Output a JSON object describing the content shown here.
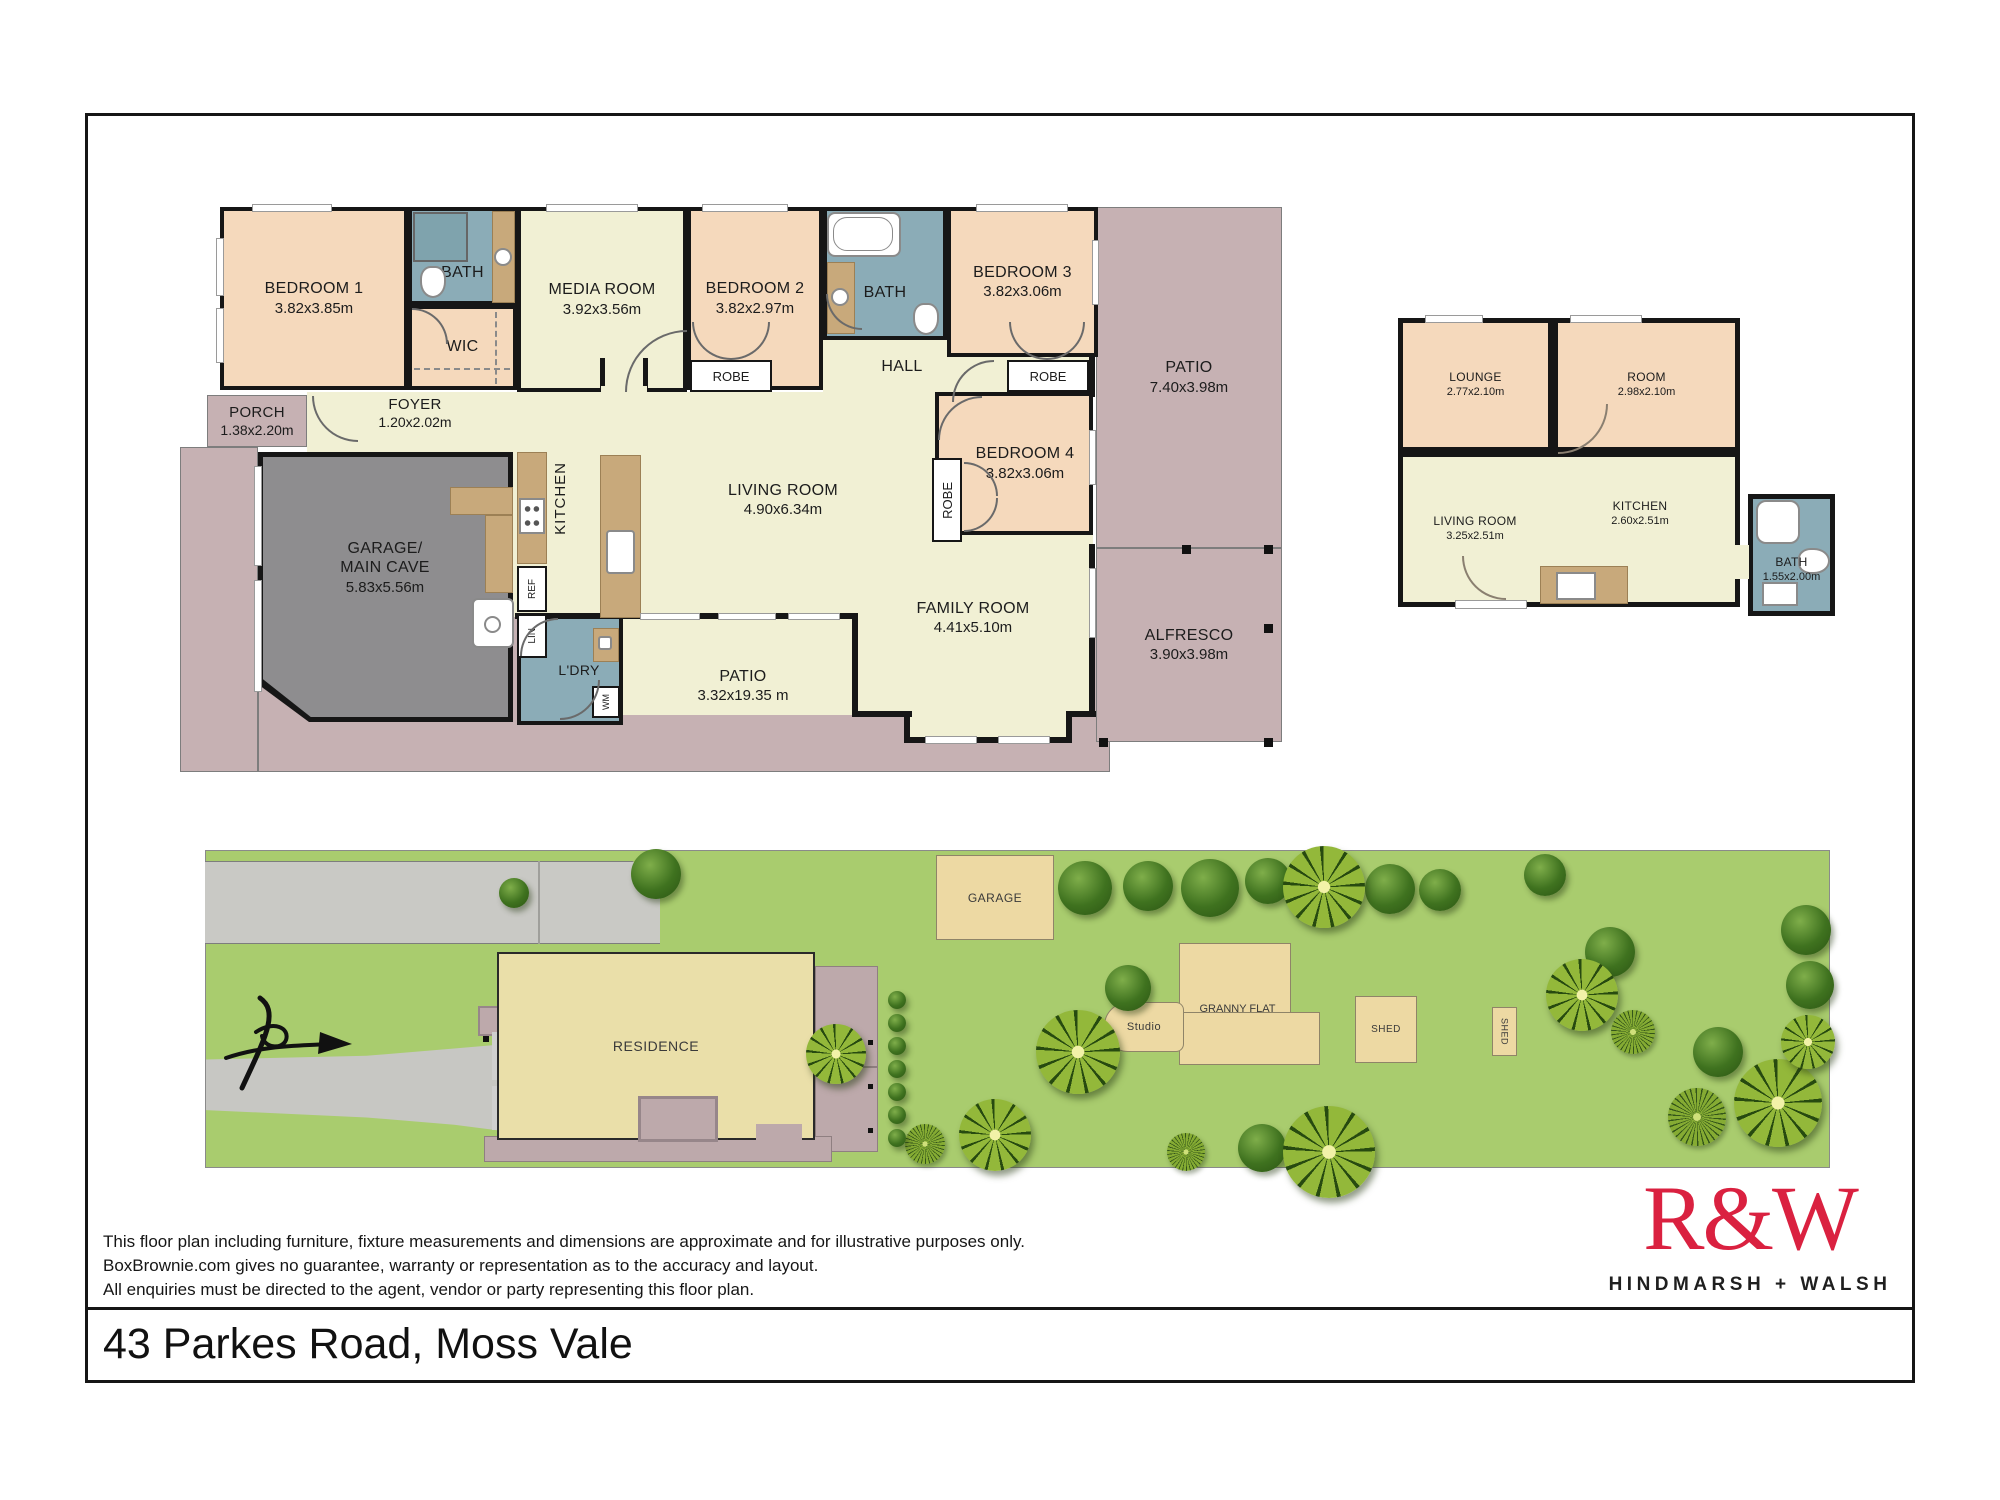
{
  "colors": {
    "brand_red": "#da2140",
    "peach_room": "#f5d9bc",
    "cream_room": "#f1f0d4",
    "teal_bath": "#8bacb7",
    "mauve_outdoor": "#c6b1b3",
    "garage_gray": "#8e8d8f",
    "site_grass": "#a9cc6e",
    "site_road": "#c9c9c5",
    "site_building": "#edd9a3",
    "site_residence": "#eadfa9"
  },
  "main_plan": {
    "bedroom1": {
      "name": "BEDROOM 1",
      "dims": "3.82x3.85m"
    },
    "bath1": {
      "name": "BATH"
    },
    "wic": {
      "name": "WIC"
    },
    "media": {
      "name": "MEDIA ROOM",
      "dims": "3.92x3.56m"
    },
    "bedroom2": {
      "name": "BEDROOM 2",
      "dims": "3.82x2.97m"
    },
    "bath2": {
      "name": "BATH"
    },
    "bedroom3": {
      "name": "BEDROOM 3",
      "dims": "3.82x3.06m"
    },
    "bedroom4": {
      "name": "BEDROOM 4",
      "dims": "3.82x3.06m"
    },
    "hall": {
      "name": "HALL"
    },
    "porch": {
      "name": "PORCH",
      "dims": "1.38x2.20m"
    },
    "foyer": {
      "name": "FOYER",
      "dims": "1.20x2.02m"
    },
    "garage": {
      "name_line1": "GARAGE/",
      "name_line2": "MAIN CAVE",
      "dims": "5.83x5.56m"
    },
    "kitchen": {
      "name": "KITCHEN"
    },
    "living": {
      "name": "LIVING ROOM",
      "dims": "4.90x6.34m"
    },
    "family": {
      "name": "FAMILY ROOM",
      "dims": "4.41x5.10m"
    },
    "laundry": {
      "name": "L'DRY"
    },
    "patio_bottom": {
      "name": "PATIO",
      "dims": "3.32x19.35 m"
    },
    "patio_right": {
      "name": "PATIO",
      "dims": "7.40x3.98m"
    },
    "alfresco": {
      "name": "ALFRESCO",
      "dims": "3.90x3.98m"
    },
    "labels": {
      "robe": "ROBE",
      "ref": "REF",
      "lin": "LIN",
      "wm": "WM"
    }
  },
  "granny_flat": {
    "lounge": {
      "name": "LOUNGE",
      "dims": "2.77x2.10m"
    },
    "room": {
      "name": "ROOM",
      "dims": "2.98x2.10m"
    },
    "living": {
      "name": "LIVING ROOM",
      "dims": "3.25x2.51m"
    },
    "kitchen": {
      "name": "KITCHEN",
      "dims": "2.60x2.51m"
    },
    "bath": {
      "name": "BATH",
      "dims": "1.55x2.00m"
    }
  },
  "site_plan": {
    "residence": "RESIDENCE",
    "garage": "GARAGE",
    "studio": "Studio",
    "granny_flat": "GRANNY FLAT",
    "shed1": "SHED",
    "shed2": "SHED"
  },
  "footer": {
    "disclaimer_line1": "This floor plan including furniture, fixture measurements and dimensions are approximate and for illustrative purposes only.",
    "disclaimer_line2": "BoxBrownie.com gives no guarantee, warranty or representation as to the accuracy and layout.",
    "disclaimer_line3": "All enquiries must be directed to the agent, vendor or party representing this floor plan.",
    "logo_brand": "R&W",
    "logo_subbrand": "HINDMARSH + WALSH",
    "address": "43 Parkes Road, Moss Vale"
  }
}
